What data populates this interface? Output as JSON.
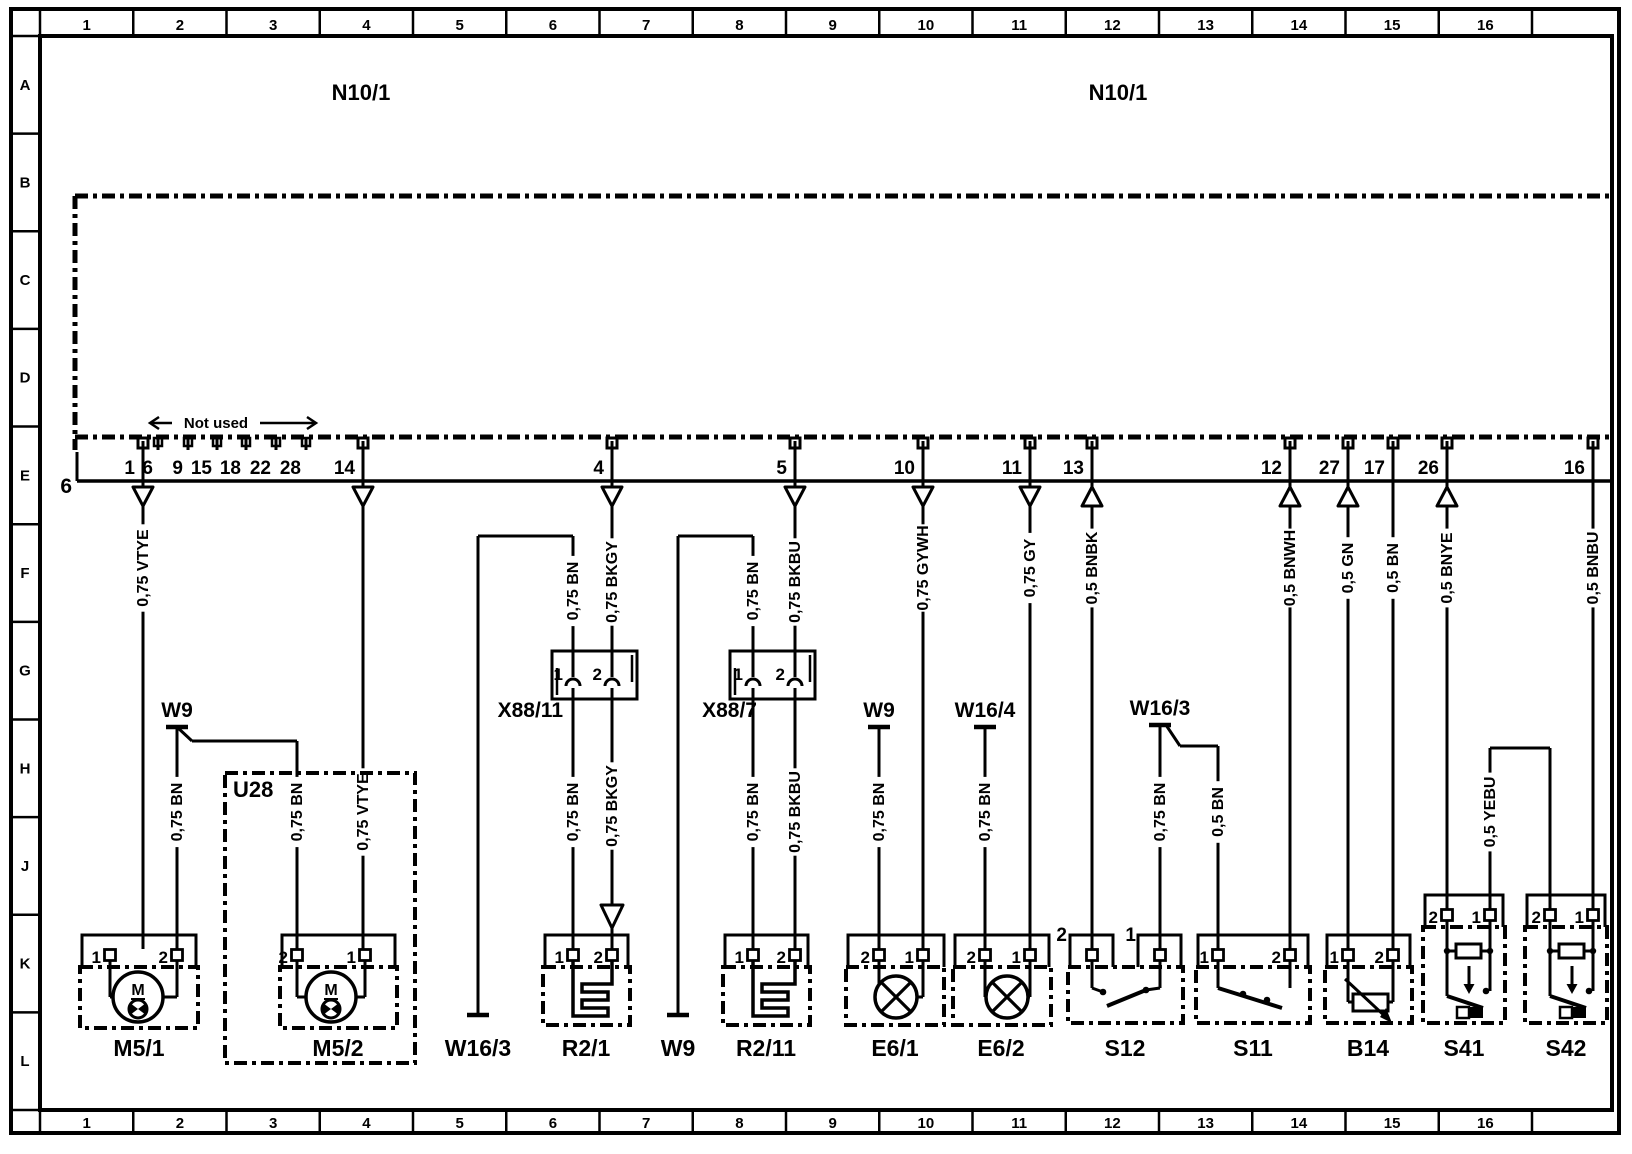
{
  "colors": {
    "ink": "#000000",
    "paper": "#ffffff"
  },
  "frame": {
    "columns": [
      "1",
      "2",
      "3",
      "4",
      "5",
      "6",
      "7",
      "8",
      "9",
      "10",
      "11",
      "12",
      "13",
      "14",
      "15",
      "16"
    ],
    "rows": [
      "A",
      "B",
      "C",
      "D",
      "E",
      "F",
      "G",
      "H",
      "J",
      "K",
      "L"
    ]
  },
  "header": {
    "unit_label_left": "N10/1",
    "unit_label_right": "N10/1",
    "bus_label": "6",
    "not_used_label": "Not used"
  },
  "connector": {
    "pins": [
      {
        "n": "1",
        "x": 143,
        "arrow": "down"
      },
      {
        "n": "14",
        "x": 363,
        "arrow": "down"
      },
      {
        "n": "4",
        "x": 612,
        "arrow": "down"
      },
      {
        "n": "5",
        "x": 795,
        "arrow": "down"
      },
      {
        "n": "10",
        "x": 923,
        "arrow": "down"
      },
      {
        "n": "11",
        "x": 1030,
        "arrow": "down"
      },
      {
        "n": "13",
        "x": 1092,
        "arrow": "up"
      },
      {
        "n": "12",
        "x": 1290,
        "arrow": "up"
      },
      {
        "n": "27",
        "x": 1348,
        "arrow": "up"
      },
      {
        "n": "17",
        "x": 1393,
        "arrow": "none"
      },
      {
        "n": "26",
        "x": 1447,
        "arrow": "up"
      },
      {
        "n": "16",
        "x": 1593,
        "arrow": "none"
      }
    ],
    "not_used_pins": [
      {
        "n": "6",
        "x": 158
      },
      {
        "n": "9",
        "x": 188
      },
      {
        "n": "15",
        "x": 217
      },
      {
        "n": "18",
        "x": 246
      },
      {
        "n": "22",
        "x": 276
      },
      {
        "n": "28",
        "x": 306
      }
    ],
    "not_used_span": [
      150,
      316,
      423
    ]
  },
  "wires": [
    {
      "x": 143,
      "y1": 508,
      "y2": 949,
      "label": "0,75 VTYE",
      "ly": 568
    },
    {
      "x": 363,
      "y1": 508,
      "y2": 949,
      "label": "0,75 VTYE",
      "ly": 812
    },
    {
      "x": 573,
      "y1": 536,
      "y2": 651,
      "label": "0,75 BN",
      "ly": 591
    },
    {
      "x": 573,
      "y1": 699,
      "y2": 949,
      "label": "0,75 BN",
      "ly": 812
    },
    {
      "x": 612,
      "y1": 508,
      "y2": 651,
      "label": "0,75 BKGY",
      "ly": 582
    },
    {
      "x": 612,
      "y1": 699,
      "y2": 949,
      "label": "0,75 BKGY",
      "ly": 806
    },
    {
      "x": 753,
      "y1": 536,
      "y2": 651,
      "label": "0,75 BN",
      "ly": 591
    },
    {
      "x": 753,
      "y1": 699,
      "y2": 949,
      "label": "0,75 BN",
      "ly": 812
    },
    {
      "x": 795,
      "y1": 508,
      "y2": 651,
      "label": "0,75 BKBU",
      "ly": 582
    },
    {
      "x": 795,
      "y1": 699,
      "y2": 949,
      "label": "0,75 BKBU",
      "ly": 812
    },
    {
      "x": 923,
      "y1": 508,
      "y2": 949,
      "label": "0,75 GYWH",
      "ly": 568
    },
    {
      "x": 879,
      "y1": 727,
      "y2": 949,
      "label": "0,75 BN",
      "ly": 812
    },
    {
      "x": 1030,
      "y1": 508,
      "y2": 949,
      "label": "0,75 GY",
      "ly": 568
    },
    {
      "x": 985,
      "y1": 727,
      "y2": 949,
      "label": "0,75 BN",
      "ly": 812
    },
    {
      "x": 1092,
      "y1": 508,
      "y2": 949,
      "label": "0,5 BNBK",
      "ly": 568
    },
    {
      "x": 1160,
      "y1": 725,
      "y2": 949,
      "label": "0,75 BN",
      "ly": 812
    },
    {
      "x": 1218,
      "y1": 746,
      "y2": 949,
      "label": "0,5 BN",
      "ly": 812
    },
    {
      "x": 1290,
      "y1": 508,
      "y2": 949,
      "label": "0,5 BNWH",
      "ly": 568
    },
    {
      "x": 1348,
      "y1": 508,
      "y2": 949,
      "label": "0,5 GN",
      "ly": 568
    },
    {
      "x": 1393,
      "y1": 481,
      "y2": 949,
      "label": "0,5 BN",
      "ly": 568
    },
    {
      "x": 1447,
      "y1": 508,
      "y2": 909,
      "label": "0,5 BNYE",
      "ly": 568
    },
    {
      "x": 1490,
      "y1": 748,
      "y2": 909,
      "label": "0,5 YEBU",
      "ly": 812
    },
    {
      "x": 1550,
      "y1": 748,
      "y2": 909,
      "label": null,
      "ly": 0
    },
    {
      "x": 1593,
      "y1": 481,
      "y2": 909,
      "label": "0,5 BNBU",
      "ly": 568
    },
    {
      "x": 177,
      "y1": 727,
      "y2": 949,
      "label": "0,75 BN",
      "ly": 812
    },
    {
      "x": 297,
      "y1": 741,
      "y2": 949,
      "label": "0,75 BN",
      "ly": 812
    },
    {
      "x": 478,
      "y1": 536,
      "y2": 1015,
      "label": null,
      "ly": 0
    },
    {
      "x": 678,
      "y1": 536,
      "y2": 1015,
      "label": null,
      "ly": 0
    }
  ],
  "lines": [
    [
      478,
      536,
      573,
      536
    ],
    [
      678,
      536,
      753,
      536
    ],
    [
      1490,
      748,
      1550,
      748
    ],
    [
      177,
      727,
      192,
      741
    ],
    [
      192,
      741,
      297,
      741
    ],
    [
      1166,
      725,
      1180,
      746
    ],
    [
      1180,
      746,
      1218,
      746
    ],
    [
      77,
      452,
      77,
      481
    ]
  ],
  "mid_arrows": [
    {
      "x": 612,
      "y1": 905,
      "y2": 928
    }
  ],
  "grounds": [
    {
      "label": "W9",
      "x": 177,
      "bar_y": 727,
      "pos": "above"
    },
    {
      "label": "W9",
      "x": 879,
      "bar_y": 727,
      "pos": "above"
    },
    {
      "label": "W16/4",
      "x": 985,
      "bar_y": 727,
      "pos": "above"
    },
    {
      "label": "W16/3",
      "x": 1160,
      "bar_y": 725,
      "pos": "above"
    },
    {
      "label": "W16/3",
      "x": 478,
      "bar_y": 1015,
      "pos": "below"
    },
    {
      "label": "W9",
      "x": 678,
      "bar_y": 1015,
      "pos": "below"
    }
  ],
  "inline_connectors": [
    {
      "label": "X88/11",
      "x1": 552,
      "x2": 637,
      "y1": 651,
      "y2": 699,
      "label_x": 563,
      "label_y": 717,
      "pins": [
        {
          "n": "1",
          "x": 573
        },
        {
          "n": "2",
          "x": 612
        }
      ]
    },
    {
      "label": "X88/7",
      "x1": 730,
      "x2": 815,
      "y1": 651,
      "y2": 699,
      "label_x": 757,
      "label_y": 717,
      "pins": [
        {
          "n": "1",
          "x": 753
        },
        {
          "n": "2",
          "x": 795
        }
      ]
    }
  ],
  "enclosure": {
    "label": "U28",
    "box": [
      225,
      773,
      190,
      290
    ],
    "label_x": 233,
    "label_y": 797
  },
  "components": [
    {
      "id": "M5/1",
      "kind": "motor",
      "label": "M5/1",
      "lx": 139,
      "boxes": [
        [
          82,
          935,
          114,
          32
        ]
      ],
      "dbox": [
        80,
        967,
        118,
        61
      ],
      "pin_y": 955,
      "pins": [
        {
          "n": "1",
          "x": 110
        },
        {
          "n": "2",
          "x": 177
        }
      ],
      "cx": 138,
      "cy": 997
    },
    {
      "id": "M5/2",
      "kind": "motor",
      "label": "M5/2",
      "lx": 338,
      "boxes": [
        [
          282,
          935,
          113,
          32
        ]
      ],
      "dbox": [
        280,
        967,
        117,
        61
      ],
      "pin_y": 955,
      "pins": [
        {
          "n": "2",
          "x": 297
        },
        {
          "n": "1",
          "x": 365
        }
      ],
      "cx": 331,
      "cy": 997
    },
    {
      "id": "R2/1",
      "kind": "heater",
      "label": "R2/1",
      "lx": 586,
      "boxes": [
        [
          545,
          935,
          83,
          32
        ]
      ],
      "dbox": [
        543,
        967,
        87,
        58
      ],
      "pin_y": 955,
      "pins": [
        {
          "n": "1",
          "x": 573
        },
        {
          "n": "2",
          "x": 612
        }
      ]
    },
    {
      "id": "R2/11",
      "kind": "heater",
      "label": "R2/11",
      "lx": 766,
      "boxes": [
        [
          725,
          935,
          83,
          32
        ]
      ],
      "dbox": [
        723,
        967,
        87,
        58
      ],
      "pin_y": 955,
      "pins": [
        {
          "n": "1",
          "x": 753
        },
        {
          "n": "2",
          "x": 795
        }
      ]
    },
    {
      "id": "E6/1",
      "kind": "lamp",
      "label": "E6/1",
      "lx": 895,
      "boxes": [
        [
          848,
          935,
          96,
          32
        ]
      ],
      "dbox": [
        846,
        967,
        98,
        58
      ],
      "pin_y": 955,
      "pins": [
        {
          "n": "2",
          "x": 879
        },
        {
          "n": "1",
          "x": 923
        }
      ],
      "cx": 896,
      "cy": 997
    },
    {
      "id": "E6/2",
      "kind": "lamp",
      "label": "E6/2",
      "lx": 1001,
      "boxes": [
        [
          955,
          935,
          94,
          32
        ]
      ],
      "dbox": [
        953,
        967,
        98,
        58
      ],
      "pin_y": 955,
      "pins": [
        {
          "n": "2",
          "x": 985
        },
        {
          "n": "1",
          "x": 1030
        }
      ],
      "cx": 1007,
      "cy": 997
    },
    {
      "id": "S12",
      "kind": "switch",
      "label": "S12",
      "lx": 1125,
      "boxes": [
        [
          1070,
          935,
          43,
          32
        ],
        [
          1138,
          935,
          43,
          32
        ]
      ],
      "dbox": [
        1068,
        967,
        115,
        56
      ],
      "pin_y": 955,
      "pins": [
        {
          "n": "2",
          "x": 1092,
          "nx": 1067,
          "ny": 941
        },
        {
          "n": "1",
          "x": 1160,
          "nx": 1136,
          "ny": 941
        }
      ],
      "sym": {
        "wire_bottom": 988,
        "stubs": [
          [
            1092,
            988,
            1103,
            992
          ],
          [
            1160,
            988,
            1146,
            990
          ]
        ],
        "dots": [
          [
            1103,
            992
          ],
          [
            1146,
            990
          ]
        ],
        "blade": [
          1146,
          990,
          1107,
          1006
        ]
      }
    },
    {
      "id": "S11",
      "kind": "switch",
      "label": "S11",
      "lx": 1253,
      "boxes": [
        [
          1198,
          935,
          110,
          32
        ]
      ],
      "dbox": [
        1196,
        967,
        114,
        56
      ],
      "pin_y": 955,
      "pins": [
        {
          "n": "1",
          "x": 1218
        },
        {
          "n": "2",
          "x": 1290
        }
      ],
      "sym": {
        "wire_bottom": 988,
        "stubs": [],
        "dots": [
          [
            1243,
            994
          ],
          [
            1267,
            1000
          ]
        ],
        "blade": [
          1218,
          988,
          1282,
          1008
        ]
      }
    },
    {
      "id": "B14",
      "kind": "rheostat",
      "label": "B14",
      "lx": 1368,
      "boxes": [
        [
          1327,
          935,
          83,
          32
        ]
      ],
      "dbox": [
        1325,
        967,
        87,
        56
      ],
      "pin_y": 955,
      "pins": [
        {
          "n": "1",
          "x": 1348
        },
        {
          "n": "2",
          "x": 1393
        }
      ]
    },
    {
      "id": "S41",
      "kind": "pushbutton",
      "label": "S41",
      "lx": 1464,
      "boxes": [
        [
          1425,
          895,
          78,
          32
        ]
      ],
      "dbox": [
        1423,
        927,
        82,
        96
      ],
      "pin_y": 915,
      "pins": [
        {
          "n": "2",
          "x": 1447
        },
        {
          "n": "1",
          "x": 1490
        }
      ]
    },
    {
      "id": "S42",
      "kind": "pushbutton",
      "label": "S42",
      "lx": 1566,
      "boxes": [
        [
          1527,
          895,
          78,
          32
        ]
      ],
      "dbox": [
        1525,
        927,
        82,
        96
      ],
      "pin_y": 915,
      "pins": [
        {
          "n": "2",
          "x": 1550
        },
        {
          "n": "1",
          "x": 1593
        }
      ]
    }
  ]
}
